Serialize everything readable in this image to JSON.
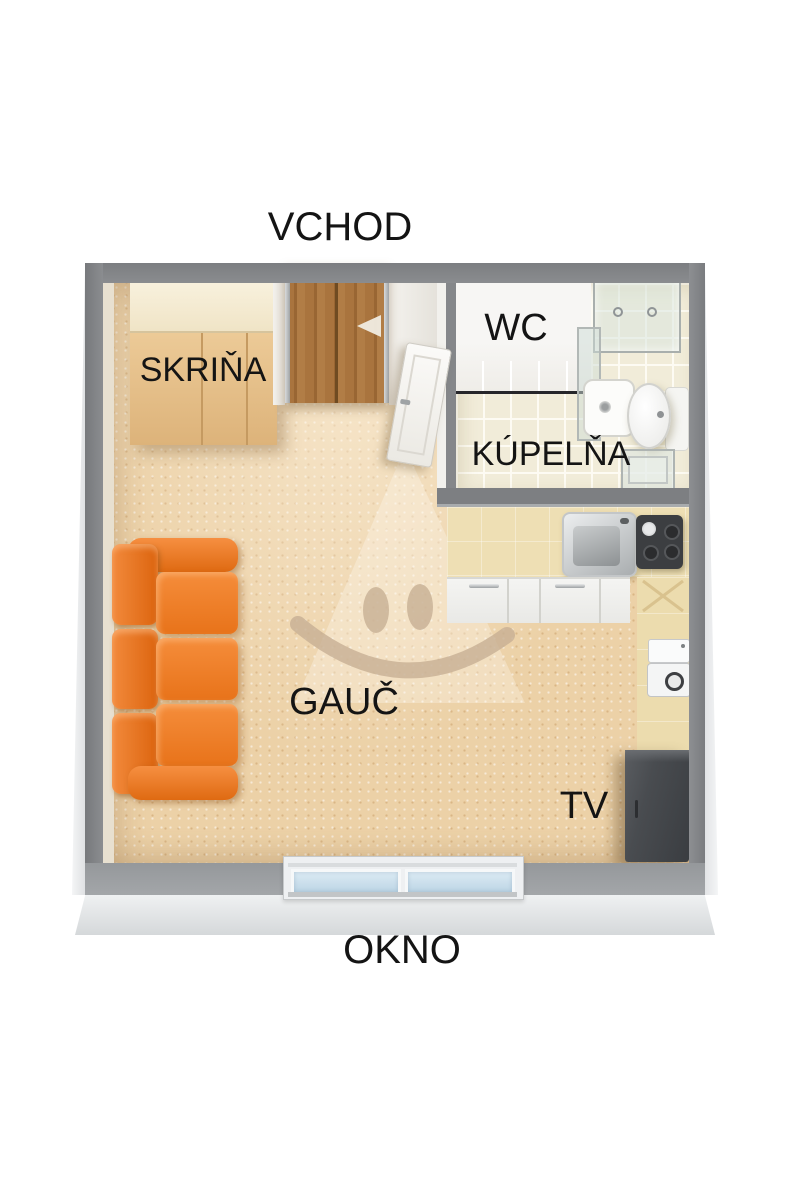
{
  "title": "Studio apartment 3D floor plan",
  "labels": {
    "entrance": "VCHOD",
    "wardrobe": "SKRIŇA",
    "wc": "WC",
    "bathroom": "KÚPELŇA",
    "couch": "GAUČ",
    "tv": "TV",
    "window": "OKNO"
  },
  "watermark": {
    "icon": "smiley-face"
  },
  "colors": {
    "background": "#ffffff",
    "wall_gray": "#85878a",
    "wall_bottom_gray": "#9a9da0",
    "wall_front_face": "#e3e5e7",
    "floor_carpet": "#ecd1a7",
    "bathroom_tile": "#f1ecd9",
    "couch_orange": "#ec7a20",
    "wardrobe_tan": "#e3bf8b",
    "wardrobe_top_cream": "#f5eed9",
    "door_wood": "#a9743e",
    "bathroom_door_white": "#f7f6f3",
    "counter_wood": "#eedfb4",
    "cabinet_white": "#f2f2f0",
    "sink_steel": "#b0b4b6",
    "cooktop_dark": "#3c3e41",
    "tv_dark": "#46494d",
    "window_glass": "#cfe2ef",
    "watermark_tan": "#c7af93",
    "label_text": "#141414"
  }
}
